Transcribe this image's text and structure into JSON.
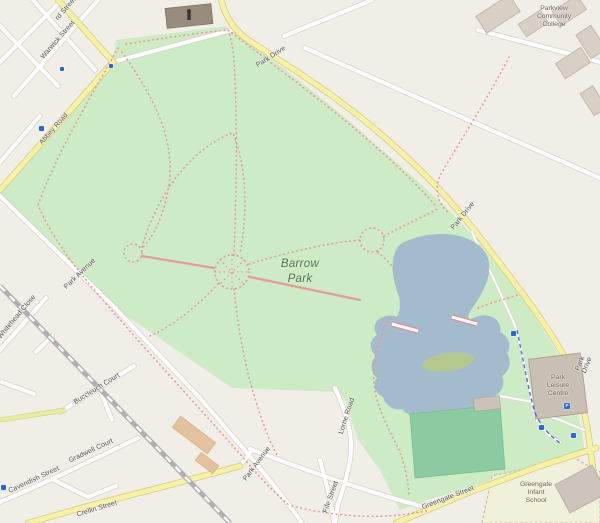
{
  "labels": {
    "park_name": "Barrow\nPark",
    "streets": {
      "rd_partial": "rd Street",
      "warwick": "Warwick Street",
      "abbey": "Abbey Road",
      "park_drive": "Park Drive",
      "park_avenue": "Park Avenue",
      "lorne": "Lorne Road",
      "fife": "Fife Street",
      "whitehead": "Whitehead Close",
      "buccleuch": "Buccleuch Court",
      "gradwell": "Gradwell Court",
      "cavendish": "Cavendish Street",
      "crellin": "Crellin Street",
      "greengate": "Greengate Street"
    },
    "places": {
      "college": "Parkview\nCommunity\nCollege",
      "leisure_centre": "Park\nLeisure\nCentre",
      "school": "Greengate\nInfant\nSchool"
    },
    "icons": {
      "parking": "P"
    }
  },
  "colors": {
    "bg": "#f1eee8",
    "park": "#cdebc4",
    "water": "#a3bbcc",
    "island": "#b5c98f",
    "pitch": "#8ccaa1",
    "road_fill": "#ffffff",
    "road_casing": "#d6d2c9",
    "road_yellow": "#f5f1a6",
    "road_yellow_casing": "#d9c87f",
    "road_lime": "#e9eda0",
    "railway": "#b0b0b0",
    "path_pink": "#e89494",
    "path_blue": "#4a6fd1",
    "marker_blue": "#2b66d9",
    "building": "#d8cfc5",
    "building_stroke": "#bfb1a1",
    "leisure_building": "#c9bfb2",
    "school_area": "#f1f0da",
    "bridge_pink": "#e08a8a"
  }
}
